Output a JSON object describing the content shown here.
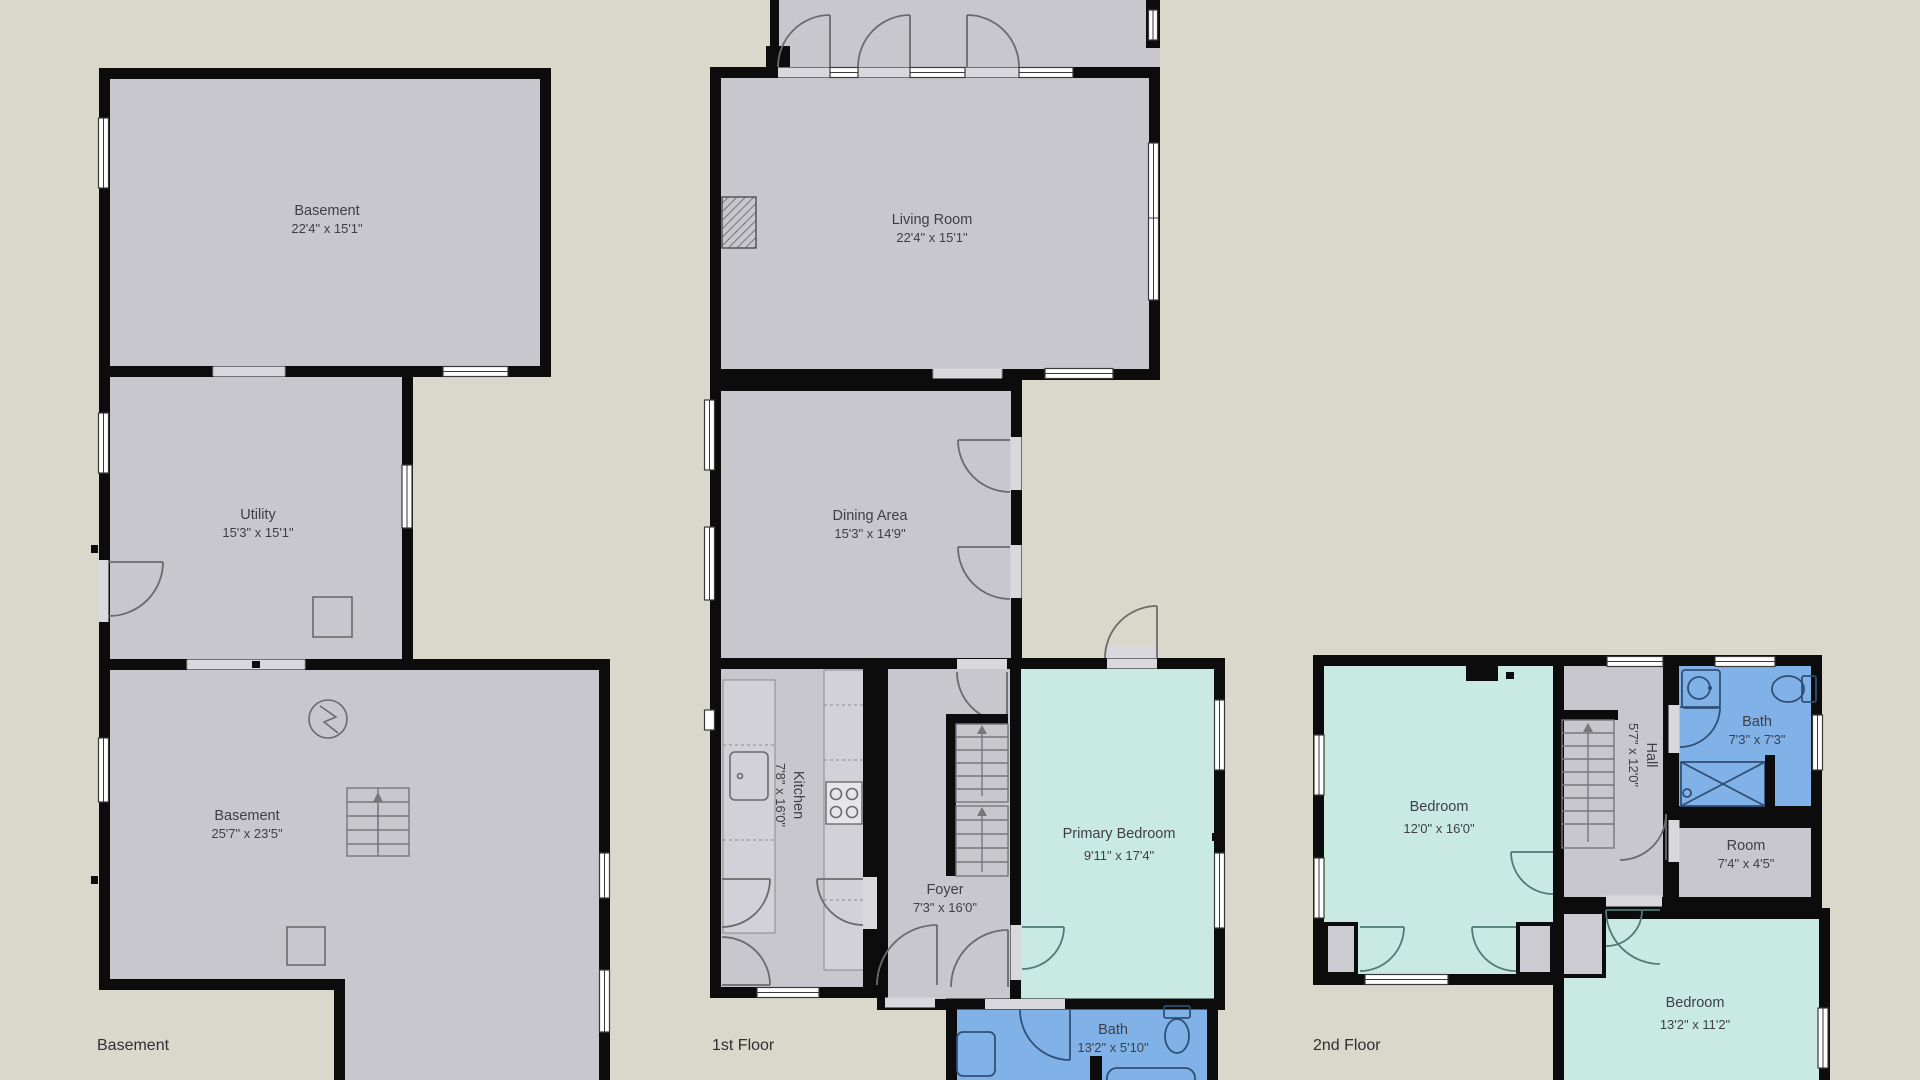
{
  "colors": {
    "background": "#D9D8CA",
    "wall": "#0C0C0C",
    "room_gray": "#C8C7CD",
    "room_teal": "#C8EAE2",
    "room_blue": "#80B2E8",
    "closet_gray": "#CDCCD2",
    "window_fill": "#FFFFFF",
    "label_text": "#3E3E45"
  },
  "floors": [
    {
      "label": "Basement",
      "rooms": [
        {
          "name": "Basement",
          "dims": "22'4\" x 15'1\""
        },
        {
          "name": "Utility",
          "dims": "15'3\" x 15'1\""
        },
        {
          "name": "Basement",
          "dims": "25'7\" x 23'5\""
        }
      ]
    },
    {
      "label": "1st Floor",
      "rooms": [
        {
          "name": "Living Room",
          "dims": "22'4\" x 15'1\""
        },
        {
          "name": "Dining Area",
          "dims": "15'3\" x 14'9\""
        },
        {
          "name": "Kitchen",
          "dims": "7'8\" x 16'0\""
        },
        {
          "name": "Foyer",
          "dims": "7'3\" x 16'0\""
        },
        {
          "name": "Primary Bedroom",
          "dims": "9'11\" x 17'4\""
        },
        {
          "name": "Bath",
          "dims": "13'2\" x 5'10\""
        }
      ]
    },
    {
      "label": "2nd Floor",
      "rooms": [
        {
          "name": "Bedroom",
          "dims": "12'0\" x 16'0\""
        },
        {
          "name": "Hall",
          "dims": "5'7\" x 12'0\""
        },
        {
          "name": "Bath",
          "dims": "7'3\" x 7'3\""
        },
        {
          "name": "Room",
          "dims": "7'4\" x 4'5\""
        },
        {
          "name": "Bedroom",
          "dims": "13'2\" x 11'2\""
        }
      ]
    }
  ]
}
